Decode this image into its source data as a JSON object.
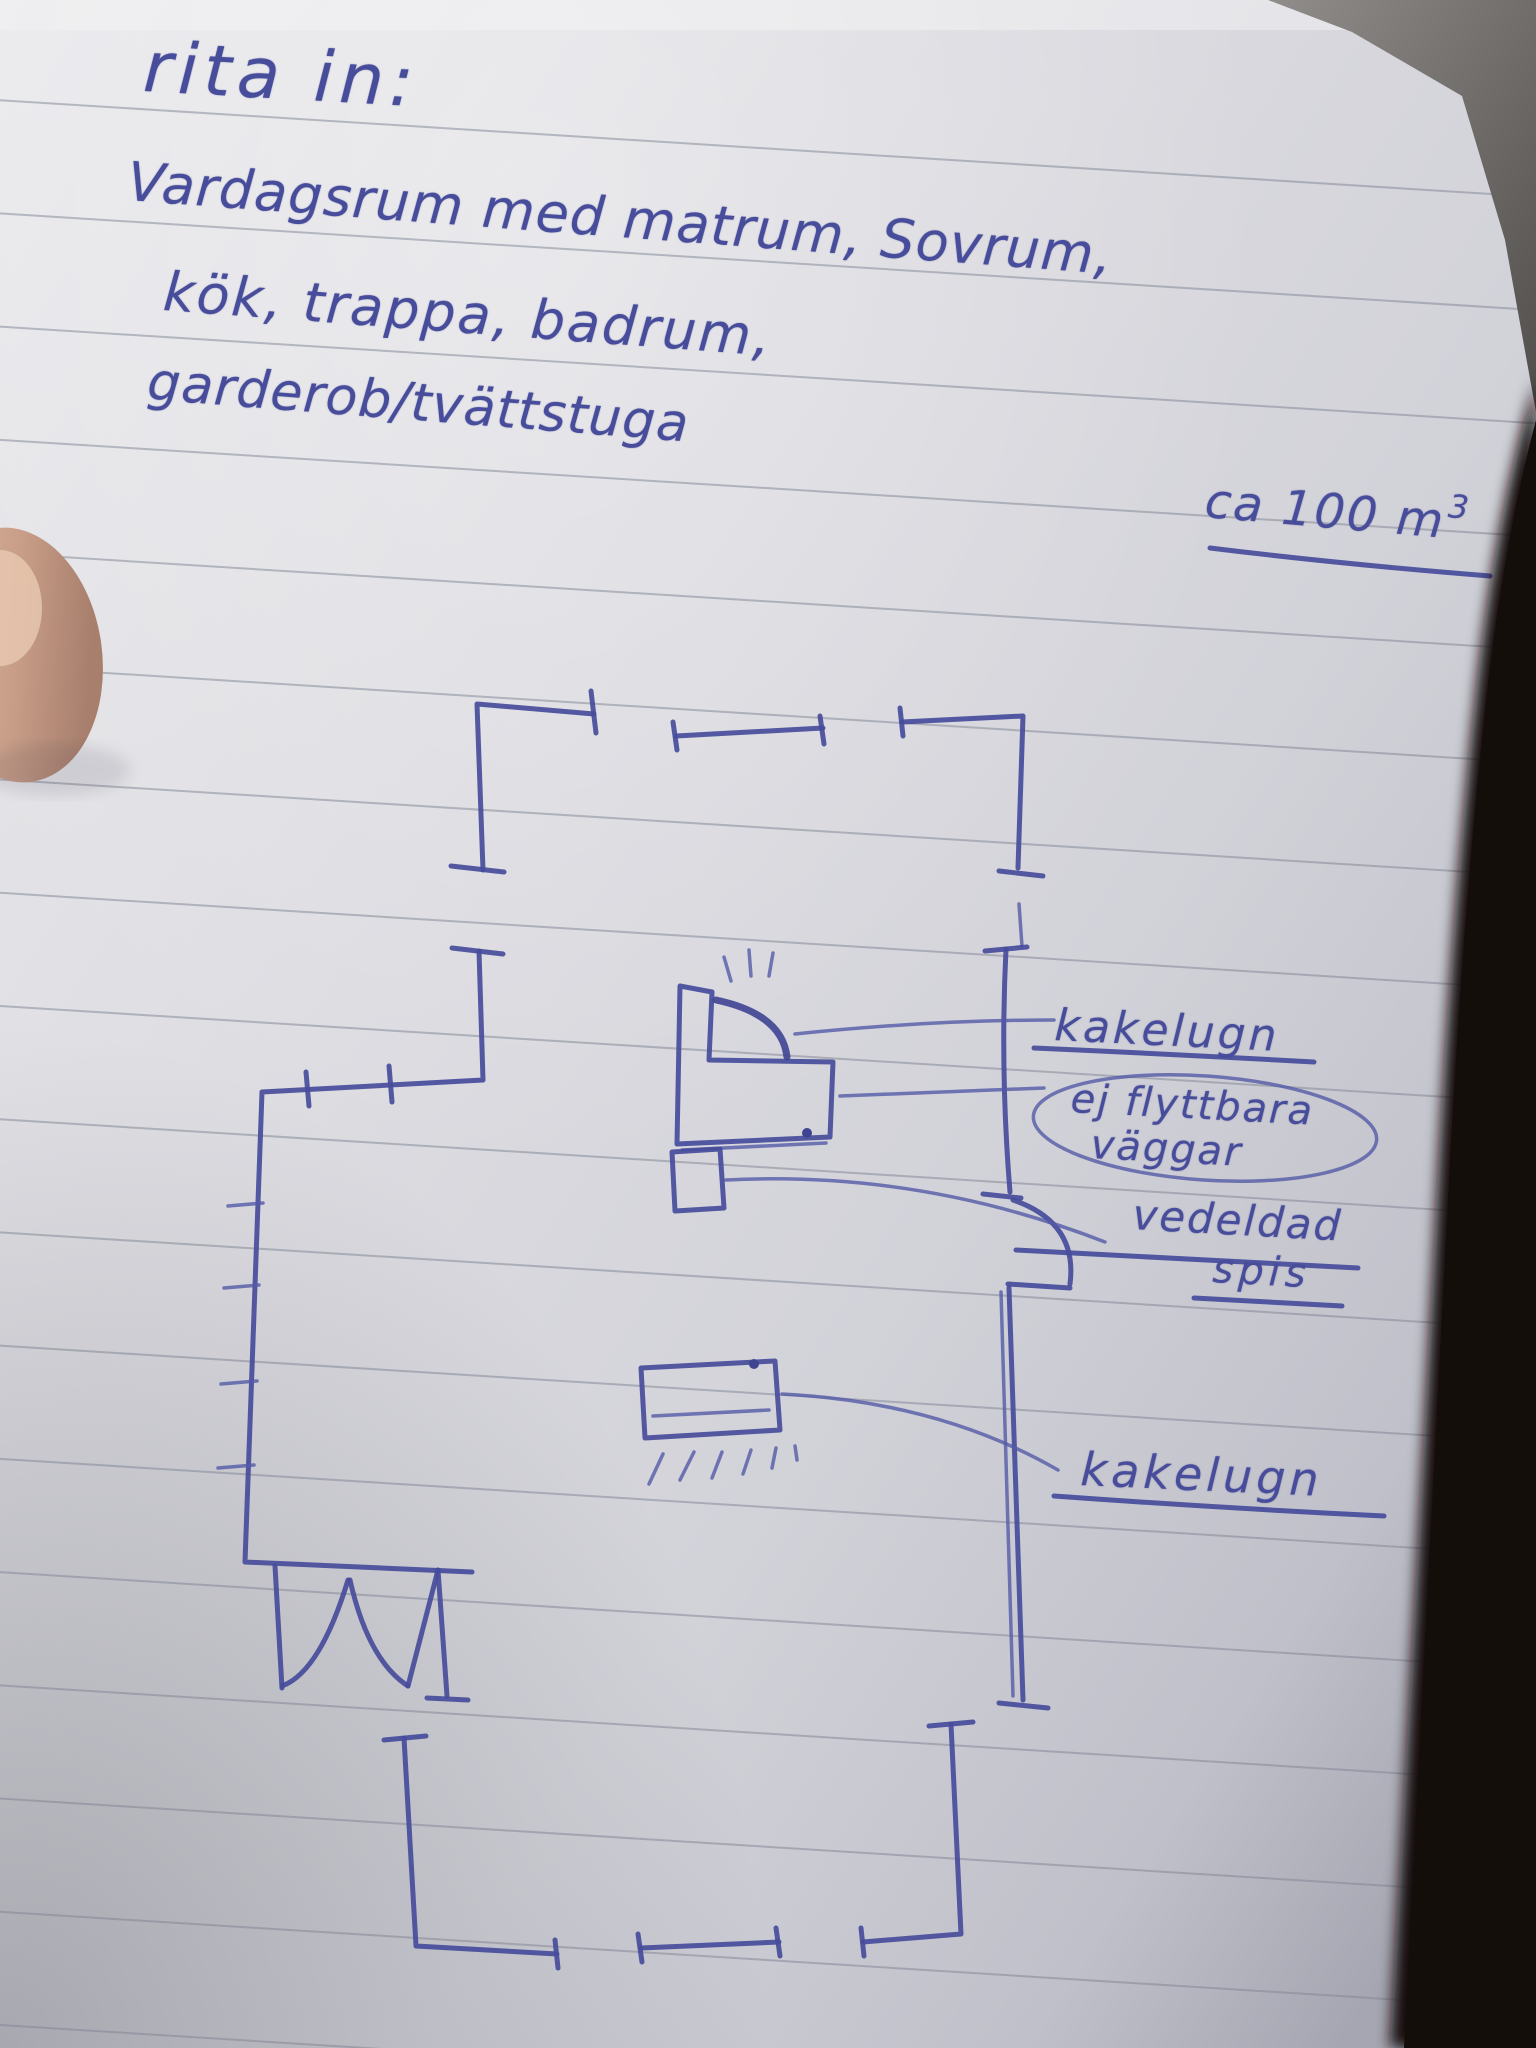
{
  "note": {
    "title": "rita in:",
    "body_lines": [
      "Vardagsrum med matrum, Sovrum,",
      "kök, trappa, badrum,",
      "garderob/tvättstuga"
    ],
    "area_text": "ca 100 m",
    "area_superscript": "3"
  },
  "labels": {
    "kakelugn_top": "kakelugn",
    "circled_line1": "ej flyttbara",
    "circled_line2": "väggar",
    "vedeldad": "vedeldad",
    "spis": "spis",
    "kakelugn_bottom": "kakelugn"
  },
  "colors": {
    "ink": "#474c9b",
    "paper": "#dadade",
    "ruled_line": "#818694",
    "photo_background": "#171210"
  }
}
